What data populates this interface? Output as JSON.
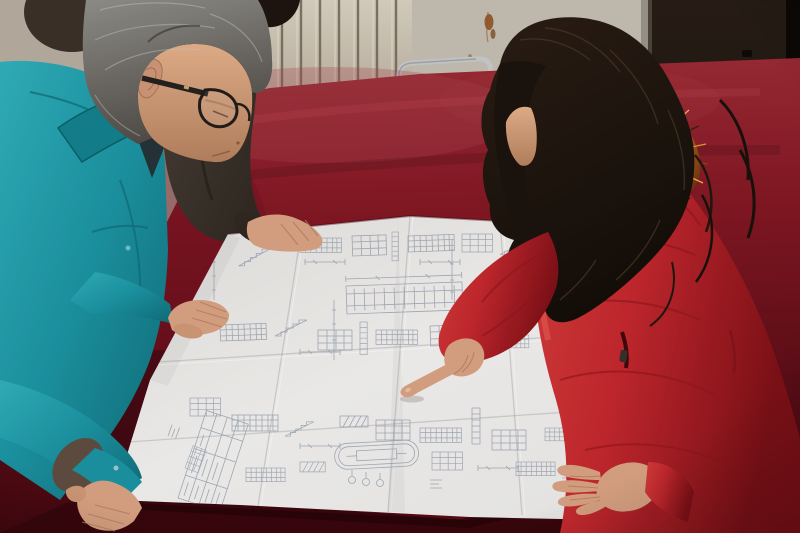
{
  "image": {
    "type": "photograph",
    "alt": "Two workers leaning over a large folded engineering blueprint spread on a crimson velvet-covered table; a man in a teal jacket with glasses studies the drawing while a woman in a red fur-hooded coat points at a detail",
    "width_px": 800,
    "height_px": 533
  },
  "scene": {
    "people": [
      {
        "id": "man-left",
        "clothing": "teal work jacket",
        "hair": "grey",
        "accessory": "black-framed glasses",
        "pose": "leaning over table, one hand on drawing, one hand on table corner"
      },
      {
        "id": "bystander-middle",
        "clothing": "dark grey-brown jacket",
        "visible": "shoulder, sleeve and hand resting on drawing"
      },
      {
        "id": "woman-right",
        "clothing": "red padded coat with orange fur-trimmed hood",
        "hair": "long dark brown wavy",
        "pose": "pointing at drawing with index finger, other hand resting on sheet"
      }
    ],
    "objects": [
      {
        "id": "blueprint",
        "desc": "large folded construction drawing with stair sections, detail tables and title block"
      },
      {
        "id": "table",
        "desc": "table draped in worn crimson velvet"
      },
      {
        "id": "radiator",
        "desc": "cream wall radiator with vertical fins"
      },
      {
        "id": "chair",
        "desc": "metal tube chair behind table"
      },
      {
        "id": "door",
        "desc": "dark brown door on the right"
      },
      {
        "id": "wall",
        "desc": "beige wall with rust stains"
      }
    ]
  },
  "colors": {
    "wall_left": "#b6ada1",
    "wall_mid": "#c4beb2",
    "radiator": "#cfc7b8",
    "radiator_fin": "#6e6459",
    "door_dark": "#1f1812",
    "door_edge": "#0b0807",
    "velvet": "#8c1b28",
    "velvet_dark": "#4e0a13",
    "velvet_light": "#a84652",
    "velvet_front": "#37060d",
    "paper": "#ececeb",
    "ink": "#96a0b0",
    "teal": "#1a93a3",
    "teal_dark": "#0e6f7c",
    "teal_light": "#2fb0bc",
    "coat_red": "#c2272e",
    "coat_dark": "#8e161d",
    "fur_orange": "#d98a2a",
    "fur_dark": "#6b330e",
    "hair_grey": "#807e7a",
    "hair_black": "#1d1410",
    "skin": "#d9a384",
    "skin_shadow": "#ad7b5e",
    "bystander_jacket": "#3f3730",
    "chair_metal": "#c6c9cc"
  }
}
